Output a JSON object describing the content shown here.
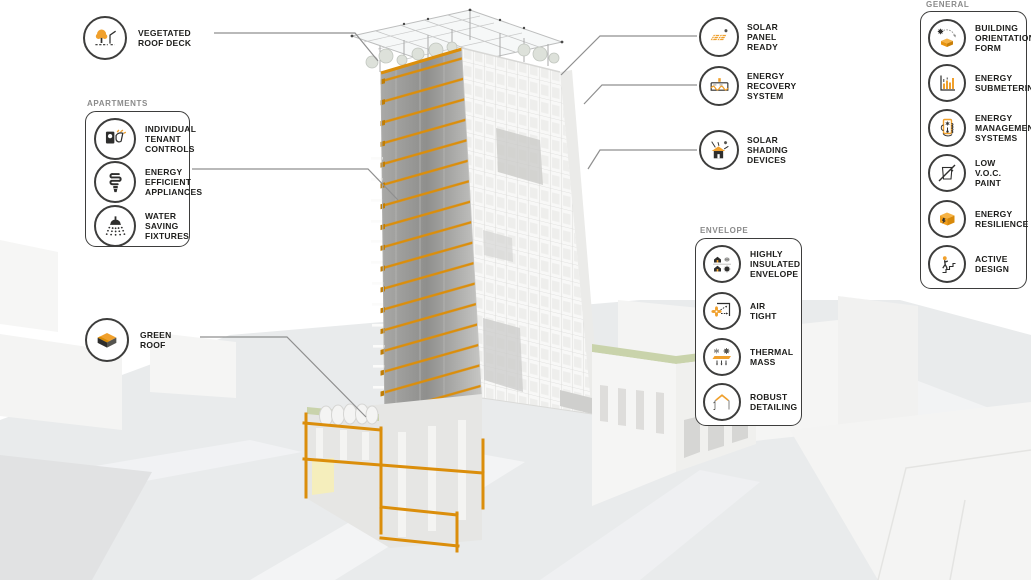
{
  "colors": {
    "accent_orange": "#F0A02C",
    "beam_orange": "#DB8E0B",
    "ink": "#1D1D1B",
    "header_grey": "#8A8A8A",
    "leader_grey": "#8F8F8F",
    "green_roof": "#C9D3AB",
    "ground_grey": "#E9EBEC"
  },
  "callouts": {
    "vegetated_roof_deck": {
      "label": "VEGETATED\nROOF DECK",
      "icon": "vegetated-roof-deck-icon"
    },
    "apartments": {
      "header": "APARTMENTS",
      "items": [
        {
          "label": "INDIVIDUAL\nTENANT\nCONTROLS",
          "icon": "tenant-controls-icon"
        },
        {
          "label": "ENERGY\nEFFICIENT\nAPPLIANCES",
          "icon": "cfl-bulb-icon"
        },
        {
          "label": "WATER\nSAVING\nFIXTURES",
          "icon": "showerhead-icon"
        }
      ]
    },
    "green_roof": {
      "label": "GREEN\nROOF",
      "icon": "green-roof-icon"
    },
    "roof_plant": [
      {
        "label": "SOLAR\nPANEL\nREADY",
        "icon": "solar-panel-icon"
      },
      {
        "label": "ENERGY\nRECOVERY\nSYSTEM",
        "icon": "energy-recovery-icon"
      },
      {
        "label": "SOLAR\nSHADING\nDEVICES",
        "icon": "solar-shading-icon"
      }
    ],
    "envelope": {
      "header": "ENVELOPE",
      "items": [
        {
          "label": "HIGHLY\nINSULATED\nENVELOPE",
          "icon": "insulated-envelope-icon"
        },
        {
          "label": "AIR\nTIGHT",
          "icon": "air-tight-icon"
        },
        {
          "label": "THERMAL\nMASS",
          "icon": "thermal-mass-icon"
        },
        {
          "label": "ROBUST\nDETAILING",
          "icon": "robust-detailing-icon"
        }
      ]
    },
    "general": {
      "header": "GENERAL",
      "items": [
        {
          "label": "BUILDING\nORIENTATION/\nFORM",
          "icon": "building-orientation-icon"
        },
        {
          "label": "ENERGY\nSUBMETERING",
          "icon": "energy-submetering-icon"
        },
        {
          "label": "ENERGY\nMANAGEMENT\nSYSTEMS",
          "icon": "energy-management-icon"
        },
        {
          "label": "LOW\nV.O.C.\nPAINT",
          "icon": "low-voc-paint-icon"
        },
        {
          "label": "ENERGY\nRESILIENCE",
          "icon": "energy-resilience-icon"
        },
        {
          "label": "ACTIVE\nDESIGN",
          "icon": "active-design-icon"
        }
      ]
    }
  }
}
